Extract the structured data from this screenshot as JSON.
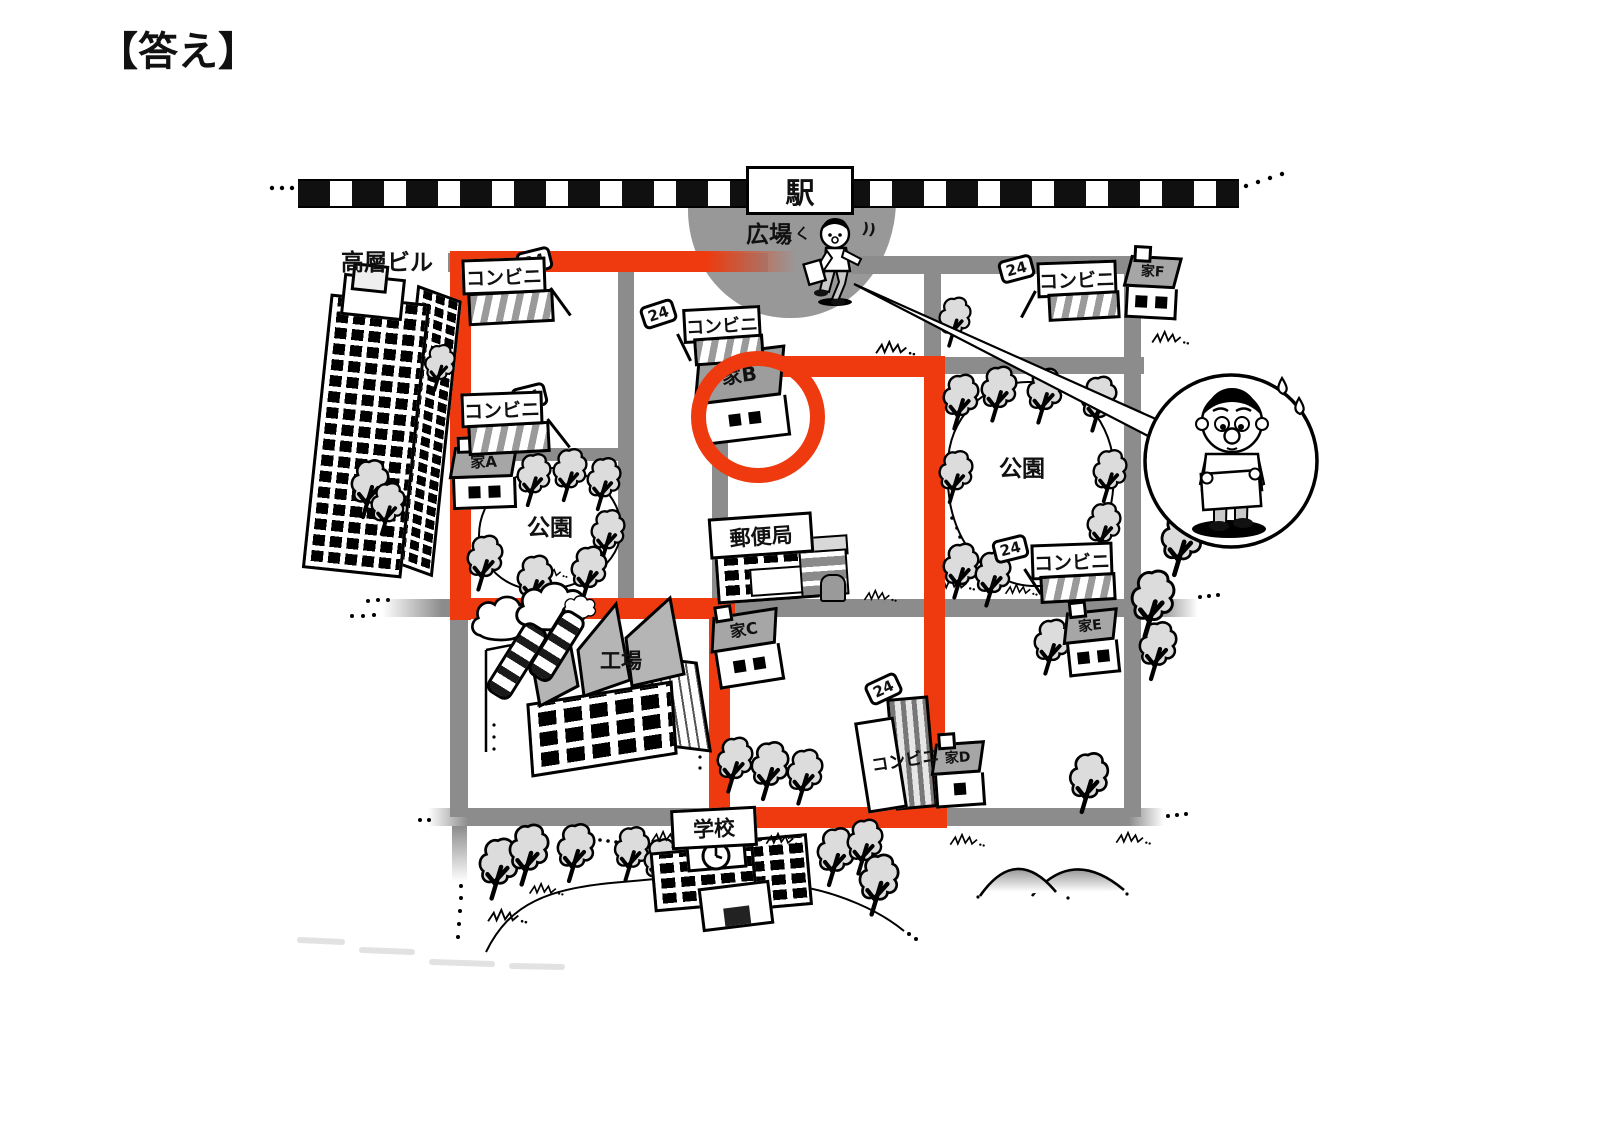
{
  "title": "【答え】",
  "station": {
    "label": "駅"
  },
  "plaza": {
    "label": "広場",
    "motion_left": "くく",
    "motion_right": "))"
  },
  "labels": {
    "high_rise": "高層ビル",
    "post_office": "郵便局",
    "factory": "工場",
    "school": "学校",
    "park": "公園",
    "convenience": "コンビニ",
    "badge_24": "24"
  },
  "houses": {
    "a": "家A",
    "b": "家B",
    "c": "家C",
    "d": "家D",
    "e": "家E",
    "f": "家F"
  },
  "answer": {
    "circled_house": "家B",
    "route_color": "#ee3a0e"
  }
}
